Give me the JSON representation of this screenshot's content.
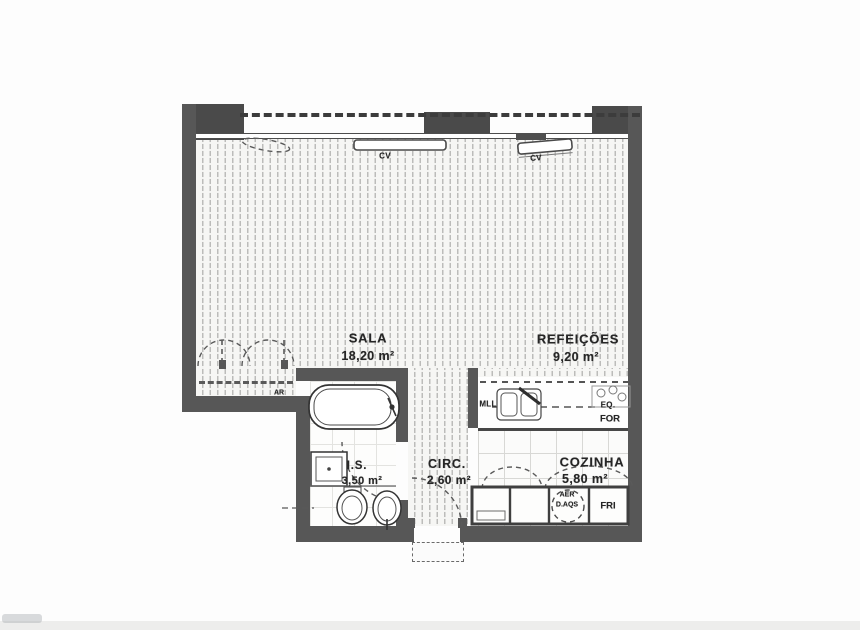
{
  "document": {
    "type": "apartment floor plan (scanned drawing)",
    "language": "Portuguese"
  },
  "rooms": [
    {
      "id": "sala",
      "name": "SALA",
      "area": "18,20 m²"
    },
    {
      "id": "refeicoes",
      "name": "REFEIÇÕES",
      "area": "9,20 m²"
    },
    {
      "id": "cozinha",
      "name": "COZINHA",
      "area": "5,80 m²"
    },
    {
      "id": "circ",
      "name": "CIRC.",
      "area": "2,60 m²"
    },
    {
      "id": "is",
      "name": "I.S.",
      "area": "3,50 m²"
    }
  ],
  "fixtures": {
    "radiator_label": "CV",
    "wardrobe_label": "AR",
    "dishwasher_label": "MLL",
    "hob_label": "EQ.",
    "oven_label": "FOR",
    "water_heater_line1": "AER",
    "water_heater_line2": "D.AQS",
    "fridge_label": "FRI"
  },
  "colors": {
    "wall": "#575757",
    "pier": "#4a4a4a",
    "drawing_line": "#333333",
    "hatch_line": "#bcbcba",
    "paper": "#fdfdfd"
  }
}
